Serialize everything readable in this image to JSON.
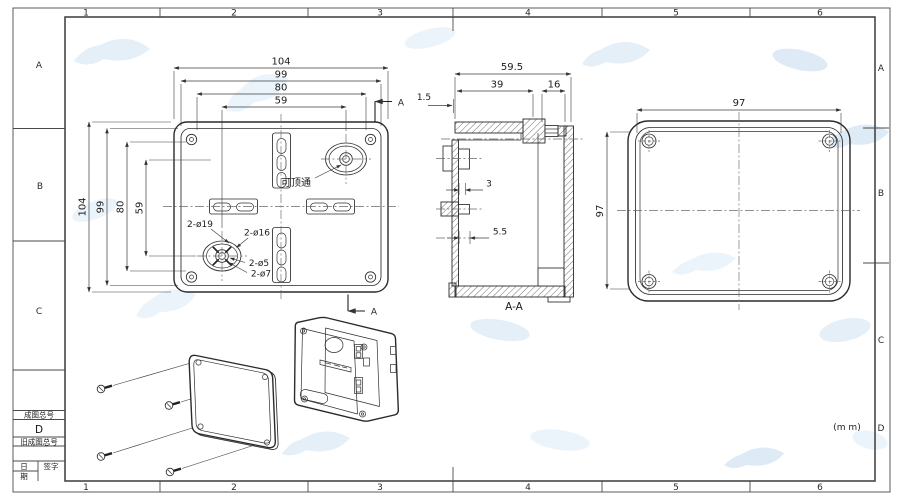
{
  "frame": {
    "top_zones": [
      "1",
      "2",
      "3",
      "4",
      "5",
      "6"
    ],
    "bottom_zones": [
      "1",
      "2",
      "3",
      "4",
      "5",
      "6"
    ],
    "left_zones": [
      "A",
      "B",
      "C"
    ],
    "right_zones": [
      "A",
      "B",
      "C",
      "D"
    ],
    "units_note": "(m m)"
  },
  "title_block": {
    "drawing_no_label": "成图总号",
    "drawing_no_value": "D",
    "old_drawing_no_label": "旧成图总号",
    "date_label_line1": "日",
    "date_label_line2": "期",
    "signature_label": "签字"
  },
  "front_view": {
    "dim_width_outer": "104",
    "dim_width_lid": "99",
    "dim_width_inner": "80",
    "dim_width_knockouts": "59",
    "dim_height_outer": "104",
    "dim_height_lid": "99",
    "dim_height_inner": "80",
    "dim_height_knockouts": "59",
    "knockout_note": "可顶通",
    "knockout_d19": "2-ø19",
    "knockout_d16": "2-ø16",
    "hole_d5": "2-ø5",
    "hole_d7": "2-ø7",
    "section_letter_top": "A",
    "section_letter_bottom": "A"
  },
  "section_view": {
    "label": "A-A",
    "dim_total_depth": "59.5",
    "dim_inner_depth": "39",
    "dim_boss_depth": "16",
    "dim_lip": "1.5",
    "dim_rib": "3",
    "dim_rib2": "5.5"
  },
  "back_view": {
    "dim_width": "97",
    "dim_height": "97"
  },
  "colors": {
    "line": "#2b2b2b",
    "dim": "#3c3c3c",
    "watermark": "#cfe2f2",
    "paper": "#ffffff"
  }
}
